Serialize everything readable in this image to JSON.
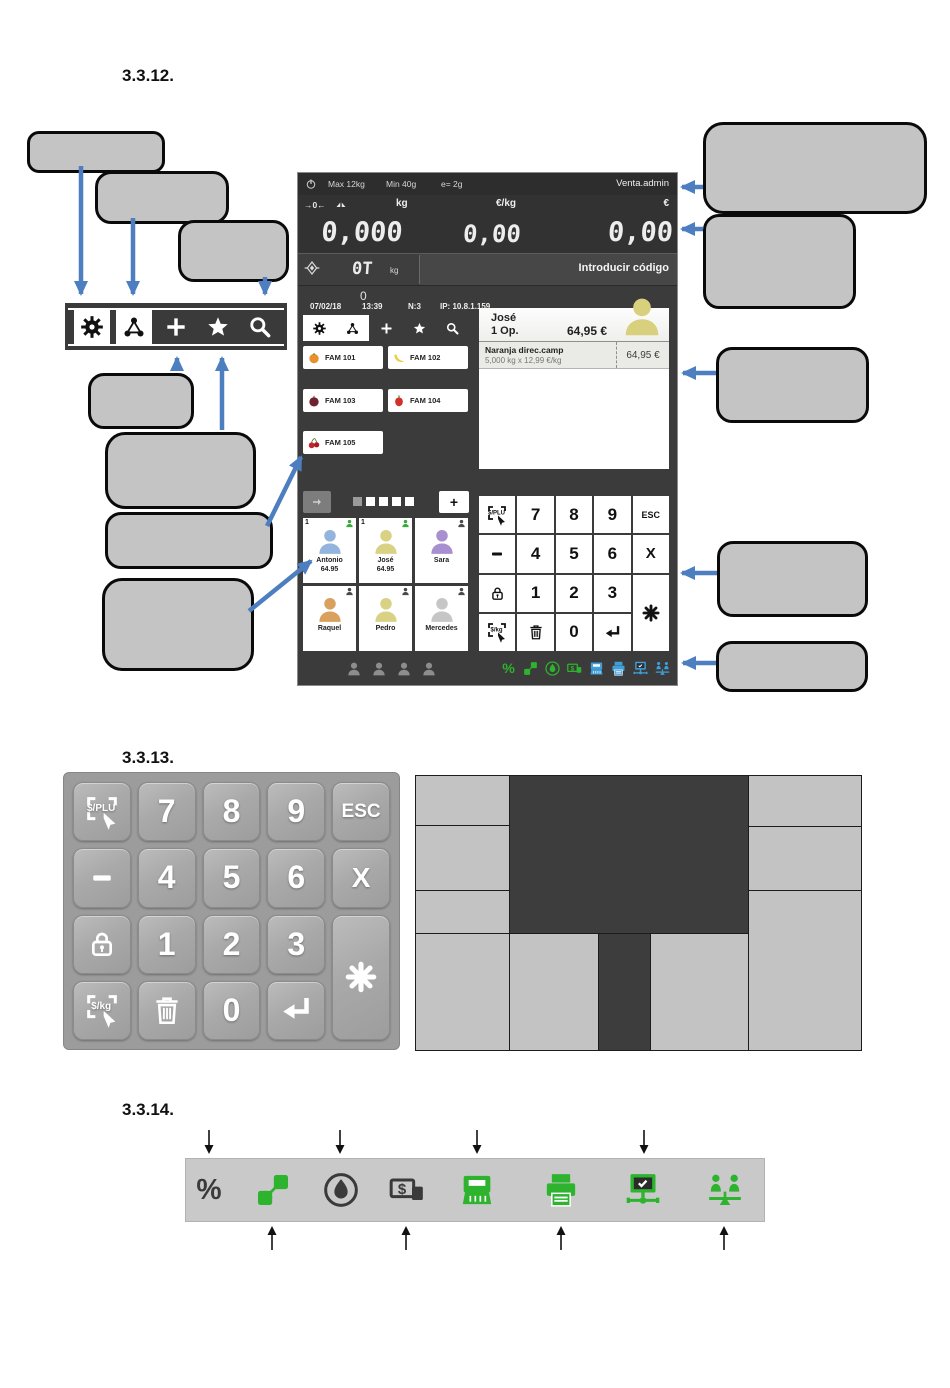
{
  "sections": {
    "s12": "3.3.12.",
    "s13": "3.3.13.",
    "s14": "3.3.14."
  },
  "colors": {
    "arrow_blue": "#4d7ebf",
    "callout_fill": "#c4c4c4",
    "icon_green": "#2db32d",
    "icon_blue": "#3f9fd8",
    "icon_dark": "#3a3a3a"
  },
  "scale_screen": {
    "metrology": {
      "max": "Max 12kg",
      "min": "Min 40g",
      "e": "e= 2g",
      "user": "Venta.admin"
    },
    "units": {
      "weight": "kg",
      "unit_price": "€/kg",
      "total": "€"
    },
    "displays": {
      "weight": "0,000",
      "unit_price": "0,00",
      "total": "0,00"
    },
    "tare": {
      "value": "0T",
      "unit": "kg",
      "prompt": "Introducir código",
      "counter": "0"
    },
    "session": {
      "date": "07/02/18",
      "time": "13:39",
      "terminal": "N:3",
      "ip": "IP: 10.8.1.159"
    },
    "toolbar": {
      "items": [
        {
          "icon": "gear-icon",
          "active": true
        },
        {
          "icon": "network-icon",
          "active": true
        },
        {
          "icon": "add-icon",
          "active": false
        },
        {
          "icon": "star-icon",
          "active": false
        },
        {
          "icon": "search-icon",
          "active": false
        }
      ]
    },
    "families": [
      {
        "label": "FAM 101",
        "icon": "fruit-orange"
      },
      {
        "label": "FAM 102",
        "icon": "fruit-banana"
      },
      {
        "label": "FAM 103",
        "icon": "fruit-plum"
      },
      {
        "label": "FAM 104",
        "icon": "fruit-pepper"
      },
      {
        "label": "FAM 105",
        "icon": "fruit-cherries"
      }
    ],
    "operator_panel": {
      "name": "José",
      "ops": "1 Op.",
      "total": "64,95 €",
      "avatar_color": "#d8d07c",
      "ticket_line": {
        "title": "Naranja direc.camp",
        "detail": "5,000 kg x 12,99 €/kg",
        "amount": "64,95 €"
      }
    },
    "pager": {
      "dot_count": 5,
      "active_index": 0,
      "add_label": "+"
    },
    "vendors": [
      {
        "name": "Antonio",
        "amount": "64.95",
        "badge": "1",
        "color": "#92b4dd",
        "tag_color": "#3aaa3a"
      },
      {
        "name": "José",
        "amount": "64.95",
        "badge": "1",
        "color": "#d9d284",
        "tag_color": "#3aaa3a"
      },
      {
        "name": "Sara",
        "amount": "",
        "badge": "",
        "color": "#a88fd0",
        "tag_color": "#4a4a4a"
      },
      {
        "name": "Raquel",
        "amount": "",
        "badge": "",
        "color": "#d9a05e",
        "tag_color": "#4a4a4a"
      },
      {
        "name": "Pedro",
        "amount": "",
        "badge": "",
        "color": "#d9d284",
        "tag_color": "#4a4a4a"
      },
      {
        "name": "Mercedes",
        "amount": "",
        "badge": "",
        "color": "#c6c6c6",
        "tag_color": "#4a4a4a"
      }
    ],
    "keypad": {
      "keys": [
        {
          "id": "price-plu",
          "icon": "touch-plu-icon",
          "area": "k1"
        },
        {
          "id": "seven",
          "label": "7",
          "area": "n7"
        },
        {
          "id": "eight",
          "label": "8",
          "area": "n8"
        },
        {
          "id": "nine",
          "label": "9",
          "area": "n9"
        },
        {
          "id": "esc",
          "label": "ESC",
          "area": "esc"
        },
        {
          "id": "minus",
          "icon": "minus-icon",
          "area": "mi"
        },
        {
          "id": "four",
          "label": "4",
          "area": "n4"
        },
        {
          "id": "five",
          "label": "5",
          "area": "n5"
        },
        {
          "id": "six",
          "label": "6",
          "area": "n6"
        },
        {
          "id": "multiply",
          "label": "X",
          "area": "x"
        },
        {
          "id": "lock",
          "icon": "lock-icon",
          "area": "lo"
        },
        {
          "id": "one",
          "label": "1",
          "area": "n1"
        },
        {
          "id": "two",
          "label": "2",
          "area": "n2"
        },
        {
          "id": "three",
          "label": "3",
          "area": "n3"
        },
        {
          "id": "asterisk",
          "icon": "asterisk-icon",
          "area": "ast"
        },
        {
          "id": "price-kg",
          "icon": "touch-kg-icon",
          "area": "k2"
        },
        {
          "id": "delete",
          "icon": "trash-icon",
          "area": "tr"
        },
        {
          "id": "zero",
          "label": "0",
          "area": "n0"
        },
        {
          "id": "enter",
          "icon": "enter-icon",
          "area": "en"
        }
      ]
    },
    "status_bar": {
      "silhouette_count": 4,
      "icons": [
        {
          "icon": "percent-icon",
          "color": "green"
        },
        {
          "icon": "link-icon",
          "color": "green"
        },
        {
          "icon": "droplet-icon",
          "color": "green"
        },
        {
          "icon": "money-icon",
          "color": "green"
        },
        {
          "icon": "register-icon",
          "color": "blue"
        },
        {
          "icon": "printer-icon",
          "color": "blue"
        },
        {
          "icon": "monitor-network-icon",
          "color": "blue"
        },
        {
          "icon": "people-network-icon",
          "color": "blue"
        }
      ]
    }
  },
  "icon_bar": {
    "icons": [
      {
        "icon": "percent-icon",
        "color": "dark",
        "arrow": "top"
      },
      {
        "icon": "link-icon",
        "color": "green",
        "arrow": "bottom"
      },
      {
        "icon": "droplet-icon",
        "color": "dark",
        "arrow": "top"
      },
      {
        "icon": "money-icon",
        "color": "dark",
        "arrow": "bottom"
      },
      {
        "icon": "register-icon",
        "color": "green",
        "arrow": "top"
      },
      {
        "icon": "printer-icon",
        "color": "green",
        "arrow": "bottom"
      },
      {
        "icon": "monitor-network-icon",
        "color": "green",
        "arrow": "top"
      },
      {
        "icon": "people-network-icon",
        "color": "green",
        "arrow": "bottom"
      }
    ]
  }
}
